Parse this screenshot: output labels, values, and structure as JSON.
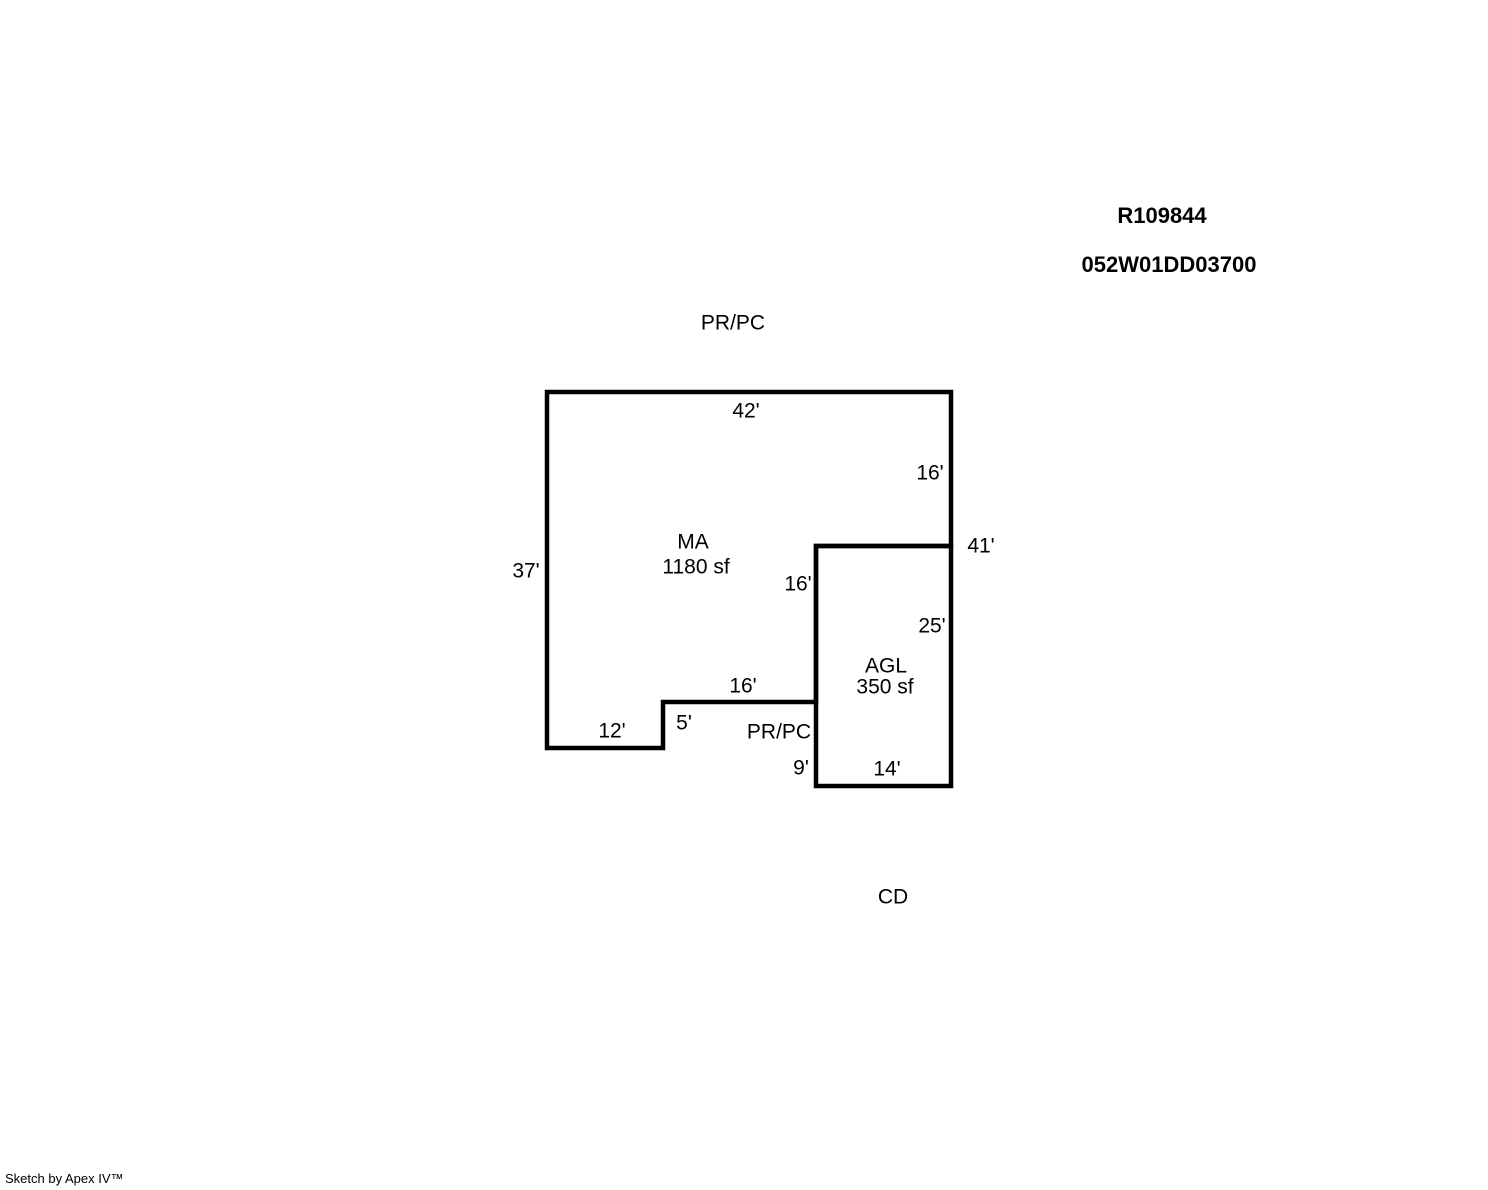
{
  "header": {
    "record_id": "R109844",
    "parcel_number": "052W01DD03700"
  },
  "sketch": {
    "top_label": "PR/PC",
    "interior_label": "PR/PC",
    "below_label": "CD",
    "areas": {
      "ma": {
        "code": "MA",
        "area": "1180 sf"
      },
      "agl": {
        "code": "AGL",
        "area": "350 sf"
      }
    },
    "dimensions": {
      "ma_top": "42'",
      "ma_right_upper": "16'",
      "right_total": "41'",
      "ma_left": "37'",
      "agl_left_upper": "16'",
      "agl_right": "25'",
      "ma_bottom": "16'",
      "ma_bottom_left": "12'",
      "ma_step": "5'",
      "agl_left_lower": "9'",
      "agl_bottom": "14'"
    }
  },
  "footer": {
    "credit": "Sketch by Apex IV™"
  },
  "colors": {
    "outline": "#000000",
    "background": "#ffffff"
  }
}
